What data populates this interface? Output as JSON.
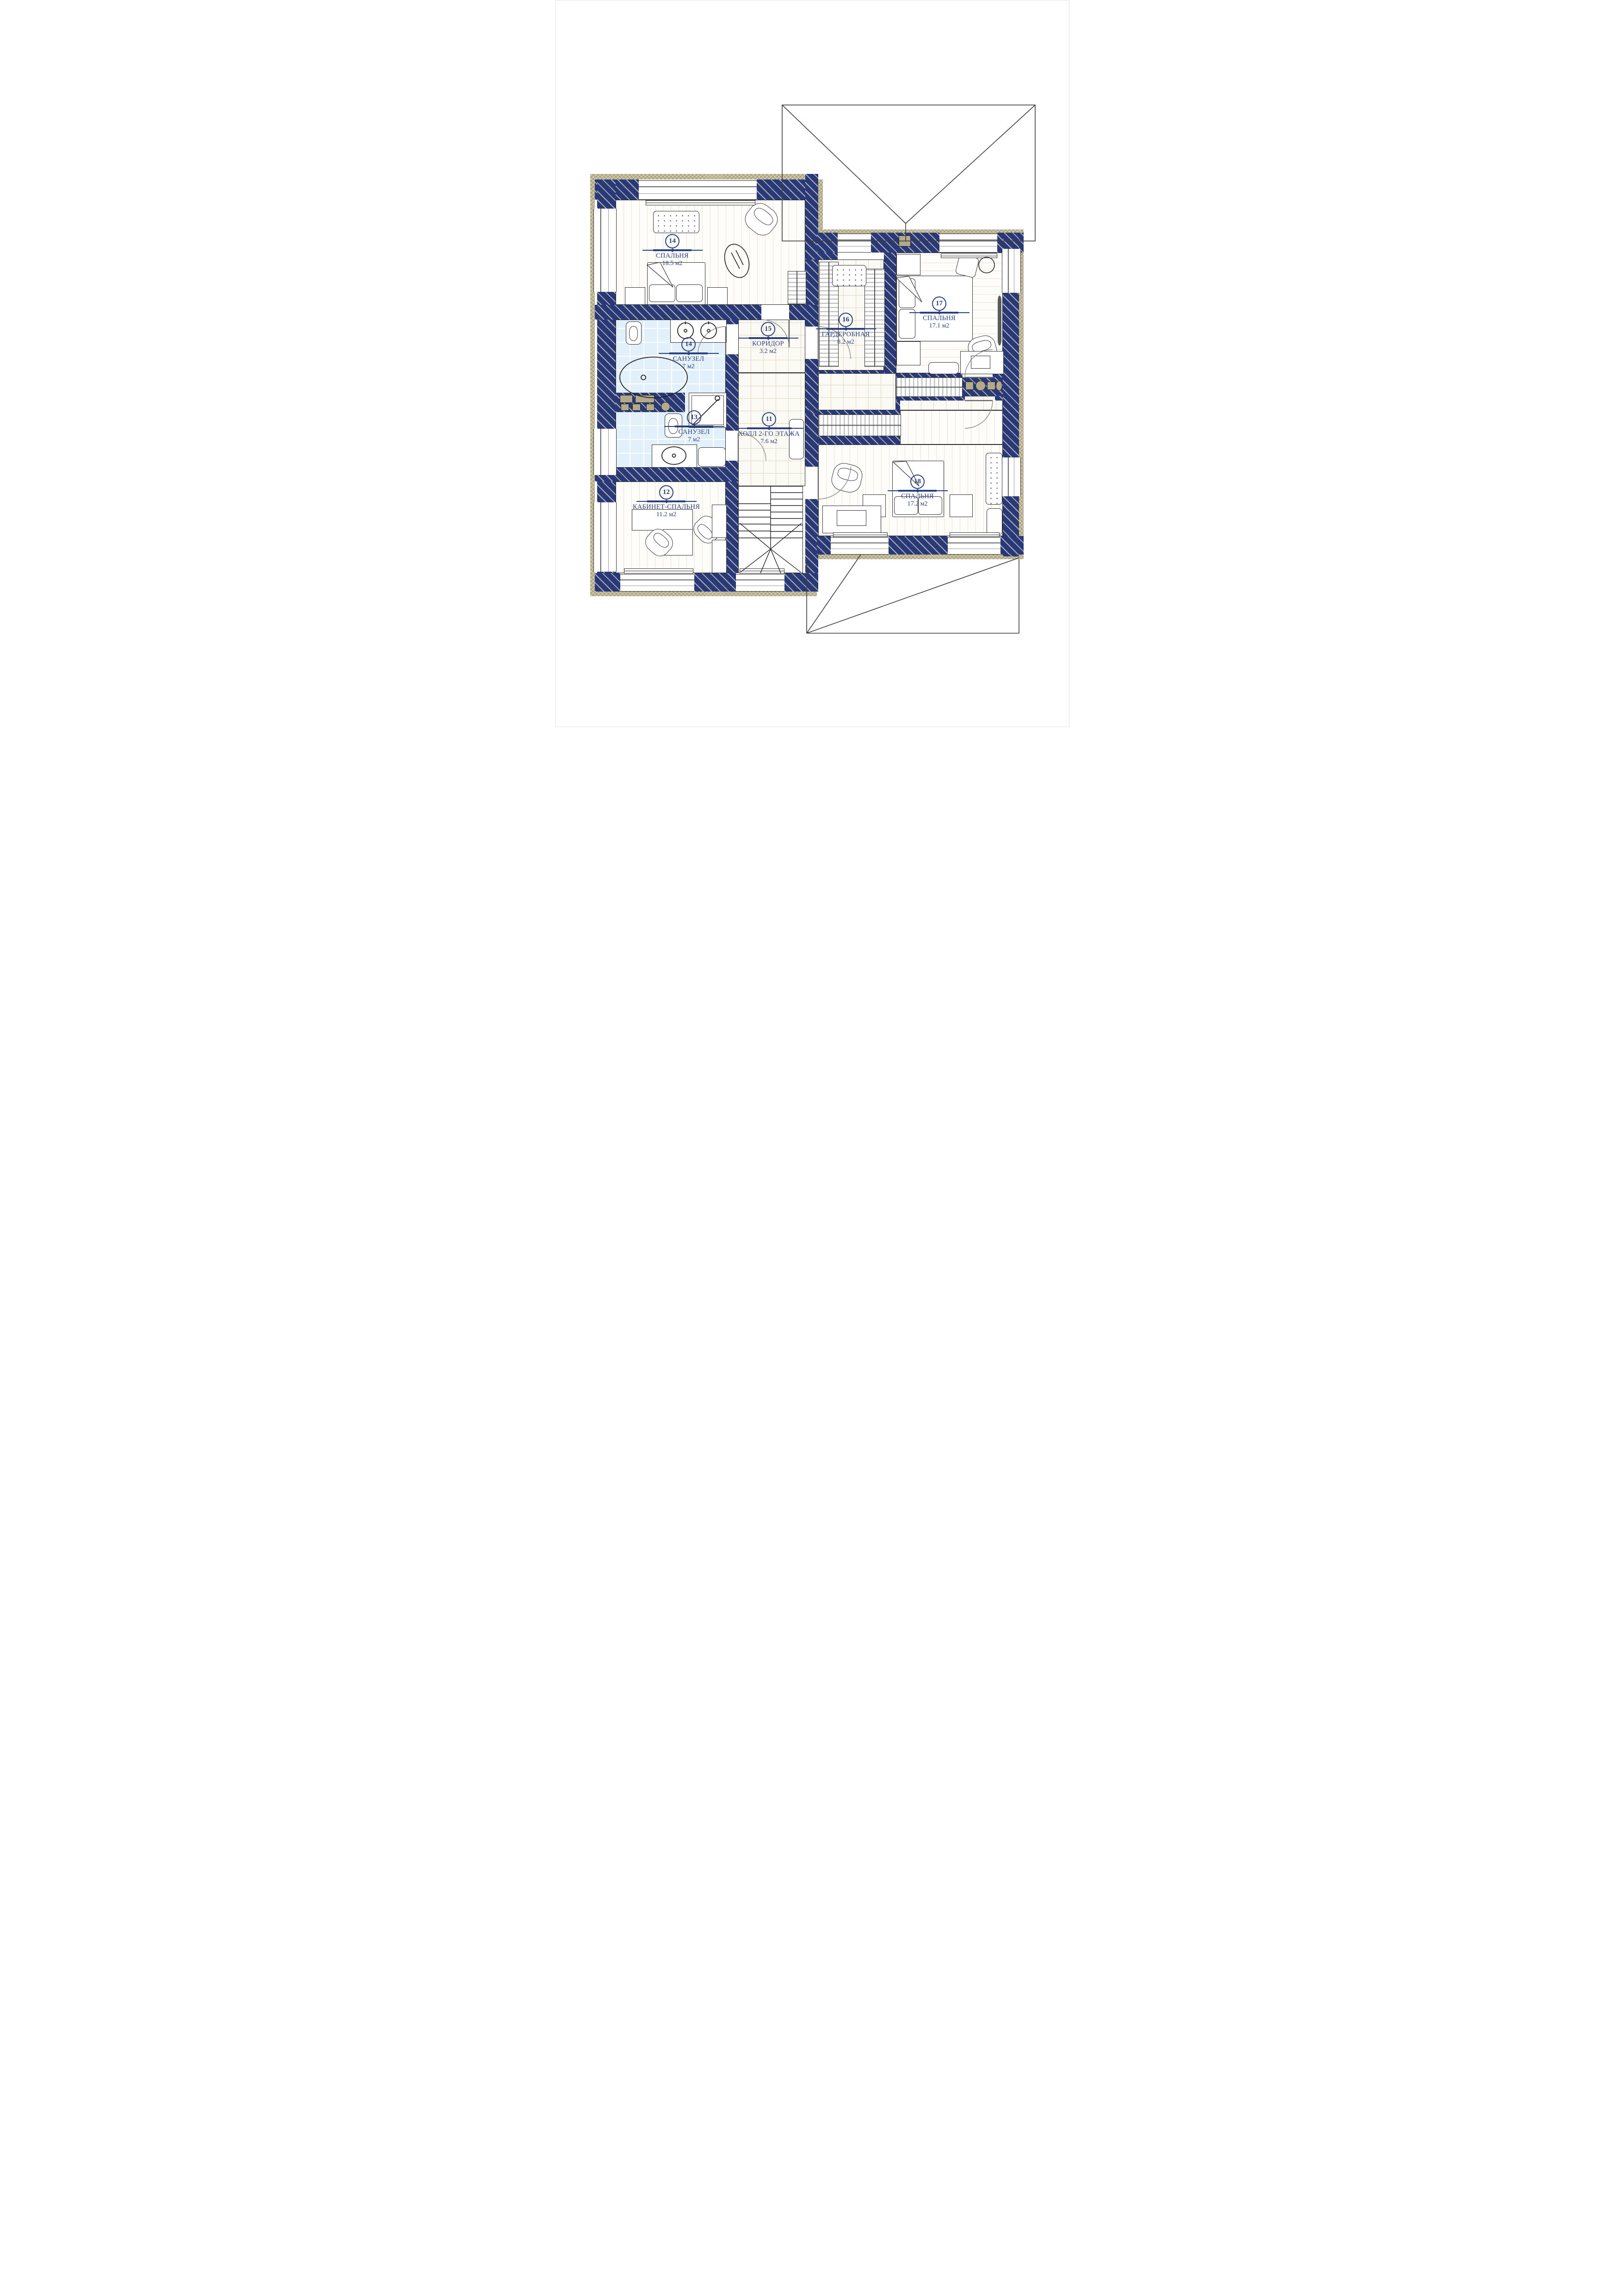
{
  "palette": {
    "wall_navy": "#27397b",
    "wall_hatch": "#cdc4a5",
    "insulation_tan": "#cdc4a5",
    "bath_tile_blue": "#e2f0fb",
    "label_navy": "#2b3f7e",
    "tile_joint": "#ded7c3",
    "plank_joint": "#e7e3d7"
  },
  "drawing": {
    "type": "second-floor-plan",
    "units": "м2"
  },
  "rooms": [
    {
      "number": "11",
      "name": "ХОЛЛ 2-ГО ЭТАЖА",
      "area": "7.6 м2"
    },
    {
      "number": "12",
      "name": "КАБИНЕТ-СПАЛЬНЯ",
      "area": "11.2 м2"
    },
    {
      "number": "13",
      "name": "САНУЗЕЛ",
      "area": "7 м2"
    },
    {
      "number": "14",
      "name": "САНУЗЕЛ",
      "area": "7 м2"
    },
    {
      "number": "14",
      "name": "СПАЛЬНЯ",
      "area": "18.5 м2"
    },
    {
      "number": "15",
      "name": "КОРИДОР",
      "area": "3.2 м2"
    },
    {
      "number": "16",
      "name": "ГАРДЕРОБНАЯ",
      "area": "8.2 м2"
    },
    {
      "number": "17",
      "name": "СПАЛЬНЯ",
      "area": "17.1 м2"
    },
    {
      "number": "18",
      "name": "СПАЛЬНЯ",
      "area": "17.2 м2"
    }
  ]
}
